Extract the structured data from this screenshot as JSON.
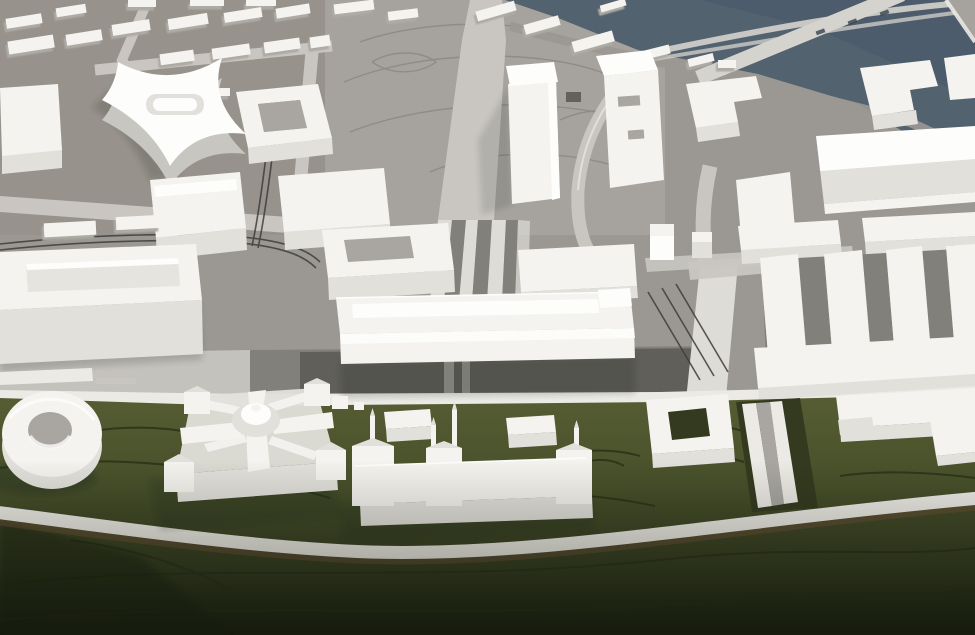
{
  "meta": {
    "title": "Architectural scale model photograph",
    "description": "Bird's-eye photograph of a white acrylic urban planning model: grey plazas and streets with engraved contours and tram tracks, a slate-blue river crossed by bridges in the upper right, rows of white massing blocks, and a dark olive-green park strip along the bottom holding detailed miniatures of a domed palace, a spired historic building, pavilions and a ring-shaped pavilion."
  },
  "palette": {
    "water": "#53626F",
    "water-dark": "#48586A",
    "ground": "#9B9893",
    "ground-warm": "#97928B",
    "plaza": "#A6A39E",
    "plaza-dark": "#82807B",
    "asphalt": "#55544F",
    "street": "#C9C6C1",
    "street-bright": "#DEDCD7",
    "sidewalk": "#ECEAE5",
    "bridge": "#D5D3CE",
    "building-top": "#F4F3EF",
    "building-bright": "#FDFDFB",
    "building-face": "#E2E0DB",
    "building-side": "#C8C6C0",
    "courtyard": "#A9A6A1",
    "track": "#3E3D3B",
    "engrave": "#8A8782",
    "green-light": "#575E34",
    "green": "#49512B",
    "green-dark": "#333A1F",
    "green-deep": "#161B0E",
    "contour": "#262D16",
    "path-shadow": "#6B4F37",
    "shadow": "rgba(35,37,32,0.35)"
  },
  "scene": {
    "regions": [
      "city-blocks-north",
      "central-plaza",
      "river",
      "bridges",
      "main-street",
      "park-strip"
    ],
    "landmarks": [
      {
        "name": "ring-building",
        "desc": "white torus-shaped pavilion on the lawn"
      },
      {
        "name": "palace-building",
        "desc": "square palace with four corner towers, radiating gabled roofs and central dome"
      },
      {
        "name": "historic-building-with-spires",
        "desc": "long low historic building with thin spires"
      },
      {
        "name": "cross-curved-building",
        "desc": "X-plan building with concave white facades"
      },
      {
        "name": "comb-building-complex",
        "desc": "comb-shaped slab complex with parallel wings"
      },
      {
        "name": "long-slab-building",
        "desc": "long horizontal slab along the main street"
      },
      {
        "name": "tower-slab-building",
        "desc": "tall white slab beside the central boulevard"
      },
      {
        "name": "hip-roof-building",
        "desc": "long hipped-roof block near the river"
      },
      {
        "name": "square-courtyard-pavilion",
        "desc": "square pavilion with open courtyard on the lawn"
      },
      {
        "name": "sunken-ramp",
        "desc": "walled ramp linking the street to the park path"
      },
      {
        "name": "park-path",
        "desc": "curving pale footpath across the park"
      }
    ],
    "bridge_count": 3,
    "pavilion_count": 2
  }
}
